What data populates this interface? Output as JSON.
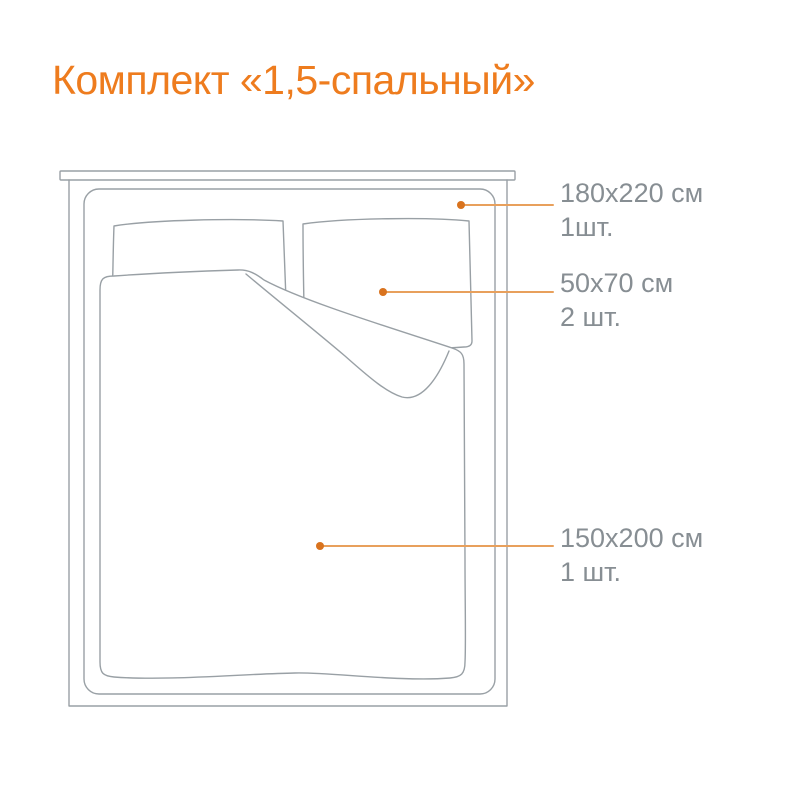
{
  "title": "Комплект «1,5-спальный»",
  "labels": {
    "duvet_cover": {
      "size": "180x220 см",
      "qty": "1шт."
    },
    "pillowcase": {
      "size": "50x70 см",
      "qty": "2 шт."
    },
    "sheet": {
      "size": "150x200 см",
      "qty": "1 шт."
    }
  },
  "colors": {
    "accent": "#EE7C1E",
    "leader_line": "#E8A05C",
    "leader_dot": "#D9731E",
    "outline": "#99A0A5",
    "label_text": "#878E93",
    "bg": "#FFFFFF"
  }
}
